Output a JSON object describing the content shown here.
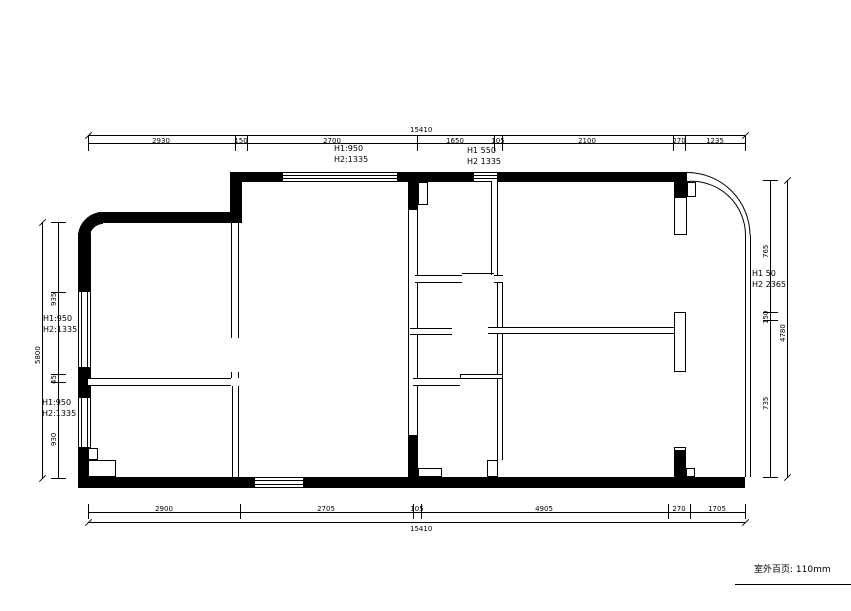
{
  "note_bottom_right": "室外百页: 110mm",
  "annotations": {
    "win_top_left": {
      "line1": "H1:950",
      "line2": "H2:1335"
    },
    "win_top_right": {
      "line1": "H1 550",
      "line2": "H2 1335"
    },
    "win_right": {
      "line1": "H1 50",
      "line2": "H2 2365"
    },
    "win_left_upper": {
      "line1": "H1:950",
      "line2": "H2:1335"
    },
    "win_left_lower": {
      "line1": "H1:950",
      "line2": "H2:1335"
    }
  },
  "dims": {
    "top_total": "15410",
    "top": [
      "2930",
      "150",
      "2700",
      "1650",
      "105",
      "2100",
      "270",
      "1235"
    ],
    "bottom_total": "15410",
    "bottom": [
      "2900",
      "2705",
      "105",
      "4905",
      "270",
      "1705"
    ],
    "left_total": "5800",
    "left": [
      "935",
      "45",
      "930"
    ],
    "right_total": "4780",
    "right": [
      "765",
      "150",
      "735"
    ]
  }
}
